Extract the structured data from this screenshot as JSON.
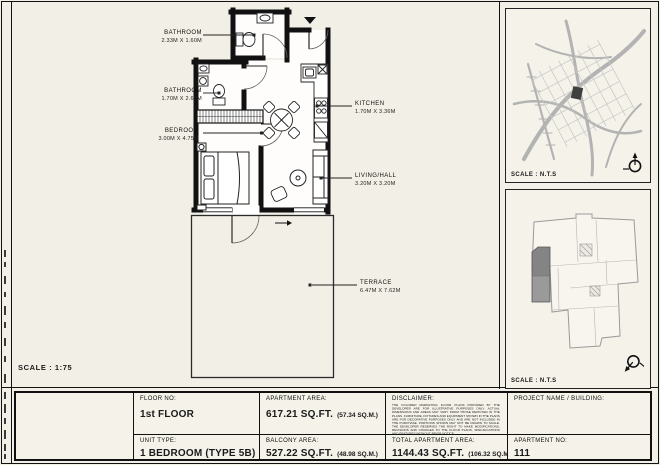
{
  "sheet": {
    "scale_label": "SCALE : 1:75",
    "colors": {
      "background": "#f2f0e6",
      "wall": "#111111",
      "map_street": "#b3b3b3",
      "unit_highlight": "#8d8d8d"
    }
  },
  "plan": {
    "rooms": [
      {
        "id": "bathroom-1",
        "name": "BATHROOM",
        "dims": "2.33M X 1.60M"
      },
      {
        "id": "bathroom-2",
        "name": "BATHROOM",
        "dims": "1.70M X 2.60M"
      },
      {
        "id": "bedroom",
        "name": "BEDROOM",
        "dims": "3.00M X 4.75M"
      },
      {
        "id": "kitchen",
        "name": "KITCHEN",
        "dims": "1.70M X 3.36M"
      },
      {
        "id": "living",
        "name": "LIVING/HALL",
        "dims": "3.20M X 3.20M"
      },
      {
        "id": "terrace",
        "name": "TERRACE",
        "dims": "6.47M X 7.62M"
      }
    ]
  },
  "side_panels": {
    "location_map": {
      "scale_label": "SCALE : N.T.S"
    },
    "key_plan": {
      "scale_label": "SCALE : N.T.S"
    }
  },
  "title_block": {
    "floor": {
      "label": "FLOOR NO:",
      "value": "1st FLOOR"
    },
    "unit_type": {
      "label": "UNIT TYPE:",
      "value": "1 BEDROOM (TYPE 5B)"
    },
    "apartment_area": {
      "label": "APARTMENT AREA:",
      "value": "617.21 SQ.FT.",
      "alt": "(57.34 SQ.M.)"
    },
    "balcony_area": {
      "label": "BALCONY AREA:",
      "value": "527.22 SQ.FT.",
      "alt": "(48.98 SQ.M.)"
    },
    "total_area": {
      "label": "TOTAL APARTMENT AREA:",
      "value": "1144.43 SQ.FT.",
      "alt": "(106.32 SQ.M.)"
    },
    "project": {
      "label": "PROJECT NAME / BUILDING:"
    },
    "apartment_no": {
      "label": "APARTMENT NO:",
      "value": "111"
    },
    "disclaimer": {
      "label": "DISCLAIMER:",
      "text": "THE COLORED MARKETING FLOOR PLANS PROVIDED BY THE DEVELOPER ARE FOR ILLUSTRATIVE PURPOSES ONLY. ACTUAL DIMENSIONS AND AREAS MAY VARY FROM THOSE DEPICTED IN THE PLANS. FURNITURE, FIXTURES AND EQUIPMENT SHOWN IN THE PLANS ARE FOR DECORATIVE PURPOSES ONLY AND ARE NOT INCLUDED IN THE PURCHASE. PORTIONS SHOWN MAY NOT BE DRAWN TO SCALE. THE DEVELOPER RESERVES THE RIGHT TO MAKE MODIFICATIONS, REVISIONS AND CHANGES TO THE FLOOR PLANS, SPECIFICATIONS AND FEATURES WITHOUT PRIOR NOTICE."
    }
  }
}
